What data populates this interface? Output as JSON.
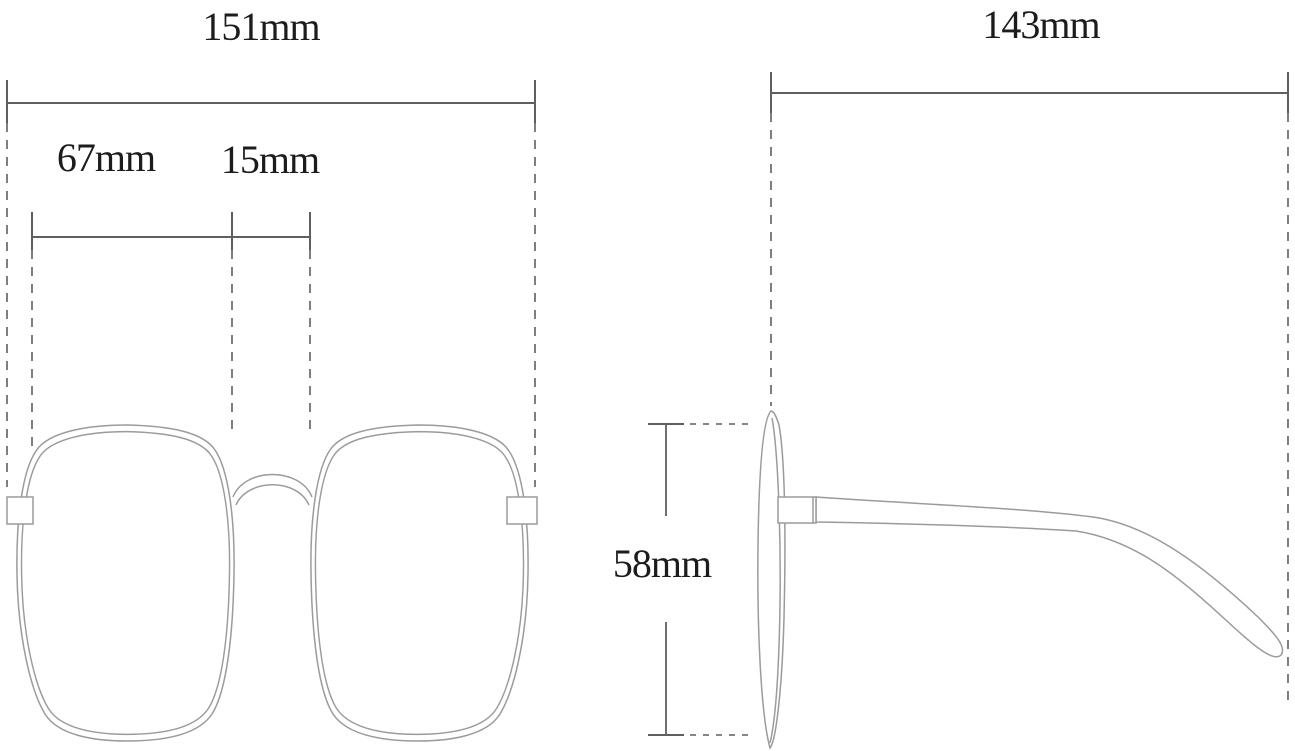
{
  "diagram": {
    "type": "eyeglasses-dimension-drawing",
    "front_view": {
      "labels": {
        "total_width": "151mm",
        "lens_width": "67mm",
        "bridge_width": "15mm"
      }
    },
    "side_view": {
      "labels": {
        "temple_length": "143mm",
        "lens_height": "58mm"
      }
    },
    "colors": {
      "outline": "#9b9b9b",
      "dimension": "#5f5f5f",
      "text": "#1c1c1c",
      "background": "#ffffff"
    }
  }
}
